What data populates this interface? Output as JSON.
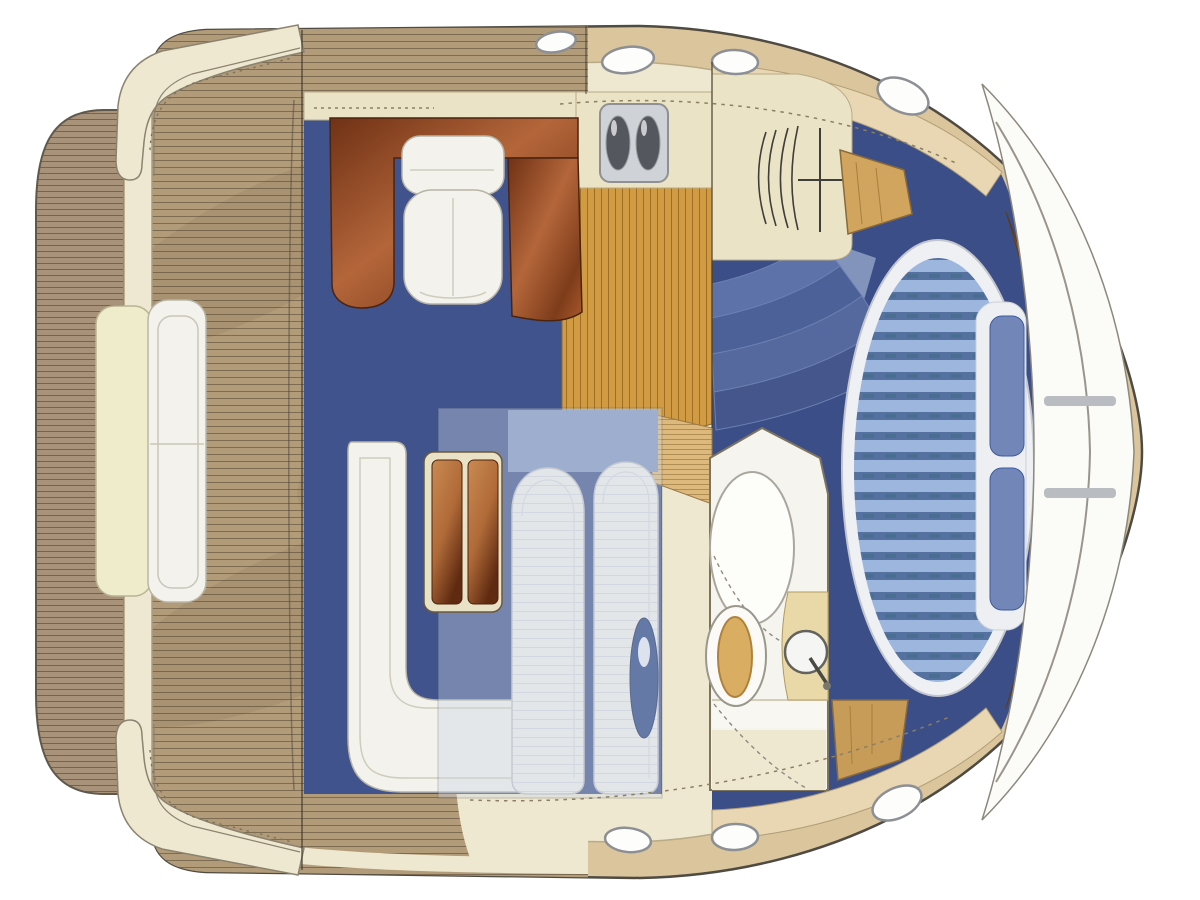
{
  "scene": {
    "type": "boat-floorplan",
    "view": "top-down",
    "orientation": "bow-right",
    "areas": [
      "swim-platform",
      "transom",
      "aft-cockpit-deck",
      "stern-bench",
      "boarding-gate-port",
      "boarding-gate-starboard",
      "helm-station",
      "salon",
      "galley",
      "mid-cabin",
      "head-compartment",
      "master-cabin",
      "bow-deck",
      "side-walkway"
    ],
    "furniture": [
      "helm-console",
      "helm-seat",
      "windshield-shelf",
      "l-shaped-sofa",
      "salon-table",
      "double-sink",
      "cooktop-cabinet",
      "companionway-steps",
      "twin-berths",
      "shower-basin",
      "toilet",
      "washbasin",
      "island-bed",
      "bed-pillows",
      "headboard-trim",
      "corner-lockers"
    ],
    "porthole_count": 7
  },
  "palette": {
    "page_bg": "#ffffff",
    "outline": "#4f4b42",
    "hull_band": "#dbc59c",
    "deck_cream": "#efe8d0",
    "gunwale": "#eee8d0",
    "transom": "#eee8d2",
    "teak": "#b29b79",
    "teak_line": "#7d6c52",
    "platform": "#a8937a",
    "platform_line": "#75644c",
    "salon_carpet": "#41538c",
    "cabin_carpet": "#3b4e88",
    "counter_cream": "#ebe3c5",
    "galley_wood": "#d09b42",
    "galley_wood_line": "#9e6f22",
    "sand_plank": "#ddb97e",
    "upholstery": "#f3f2ec",
    "berth_white": "#f1f0ea",
    "berth_line": "#d6d8de",
    "bed_stripe_light": "#9db6de",
    "bed_stripe_dark": "#54719f",
    "bed_ring": "#eef0f3",
    "pillow_blue": "#7287b8",
    "steel": "#cfd2d6",
    "basin_dark": "#54575d",
    "step1": "#5d72a8",
    "step2": "#4c6198",
    "step3": "#56699f",
    "step4": "#44568c",
    "locker_wood": "#d2a55e",
    "headboard_wood": "#8a5a2e",
    "head_wall": "#f6f4ee",
    "toilet_seat": "#d9ae62",
    "bow_white": "#fbfbf8",
    "porthole_ring": "#8c8f94",
    "navy_donut": "#24407e",
    "table_frame": "#e9e2c6",
    "mahogany_dark": "#6f3115",
    "mahogany_mid": "#b4663a"
  }
}
